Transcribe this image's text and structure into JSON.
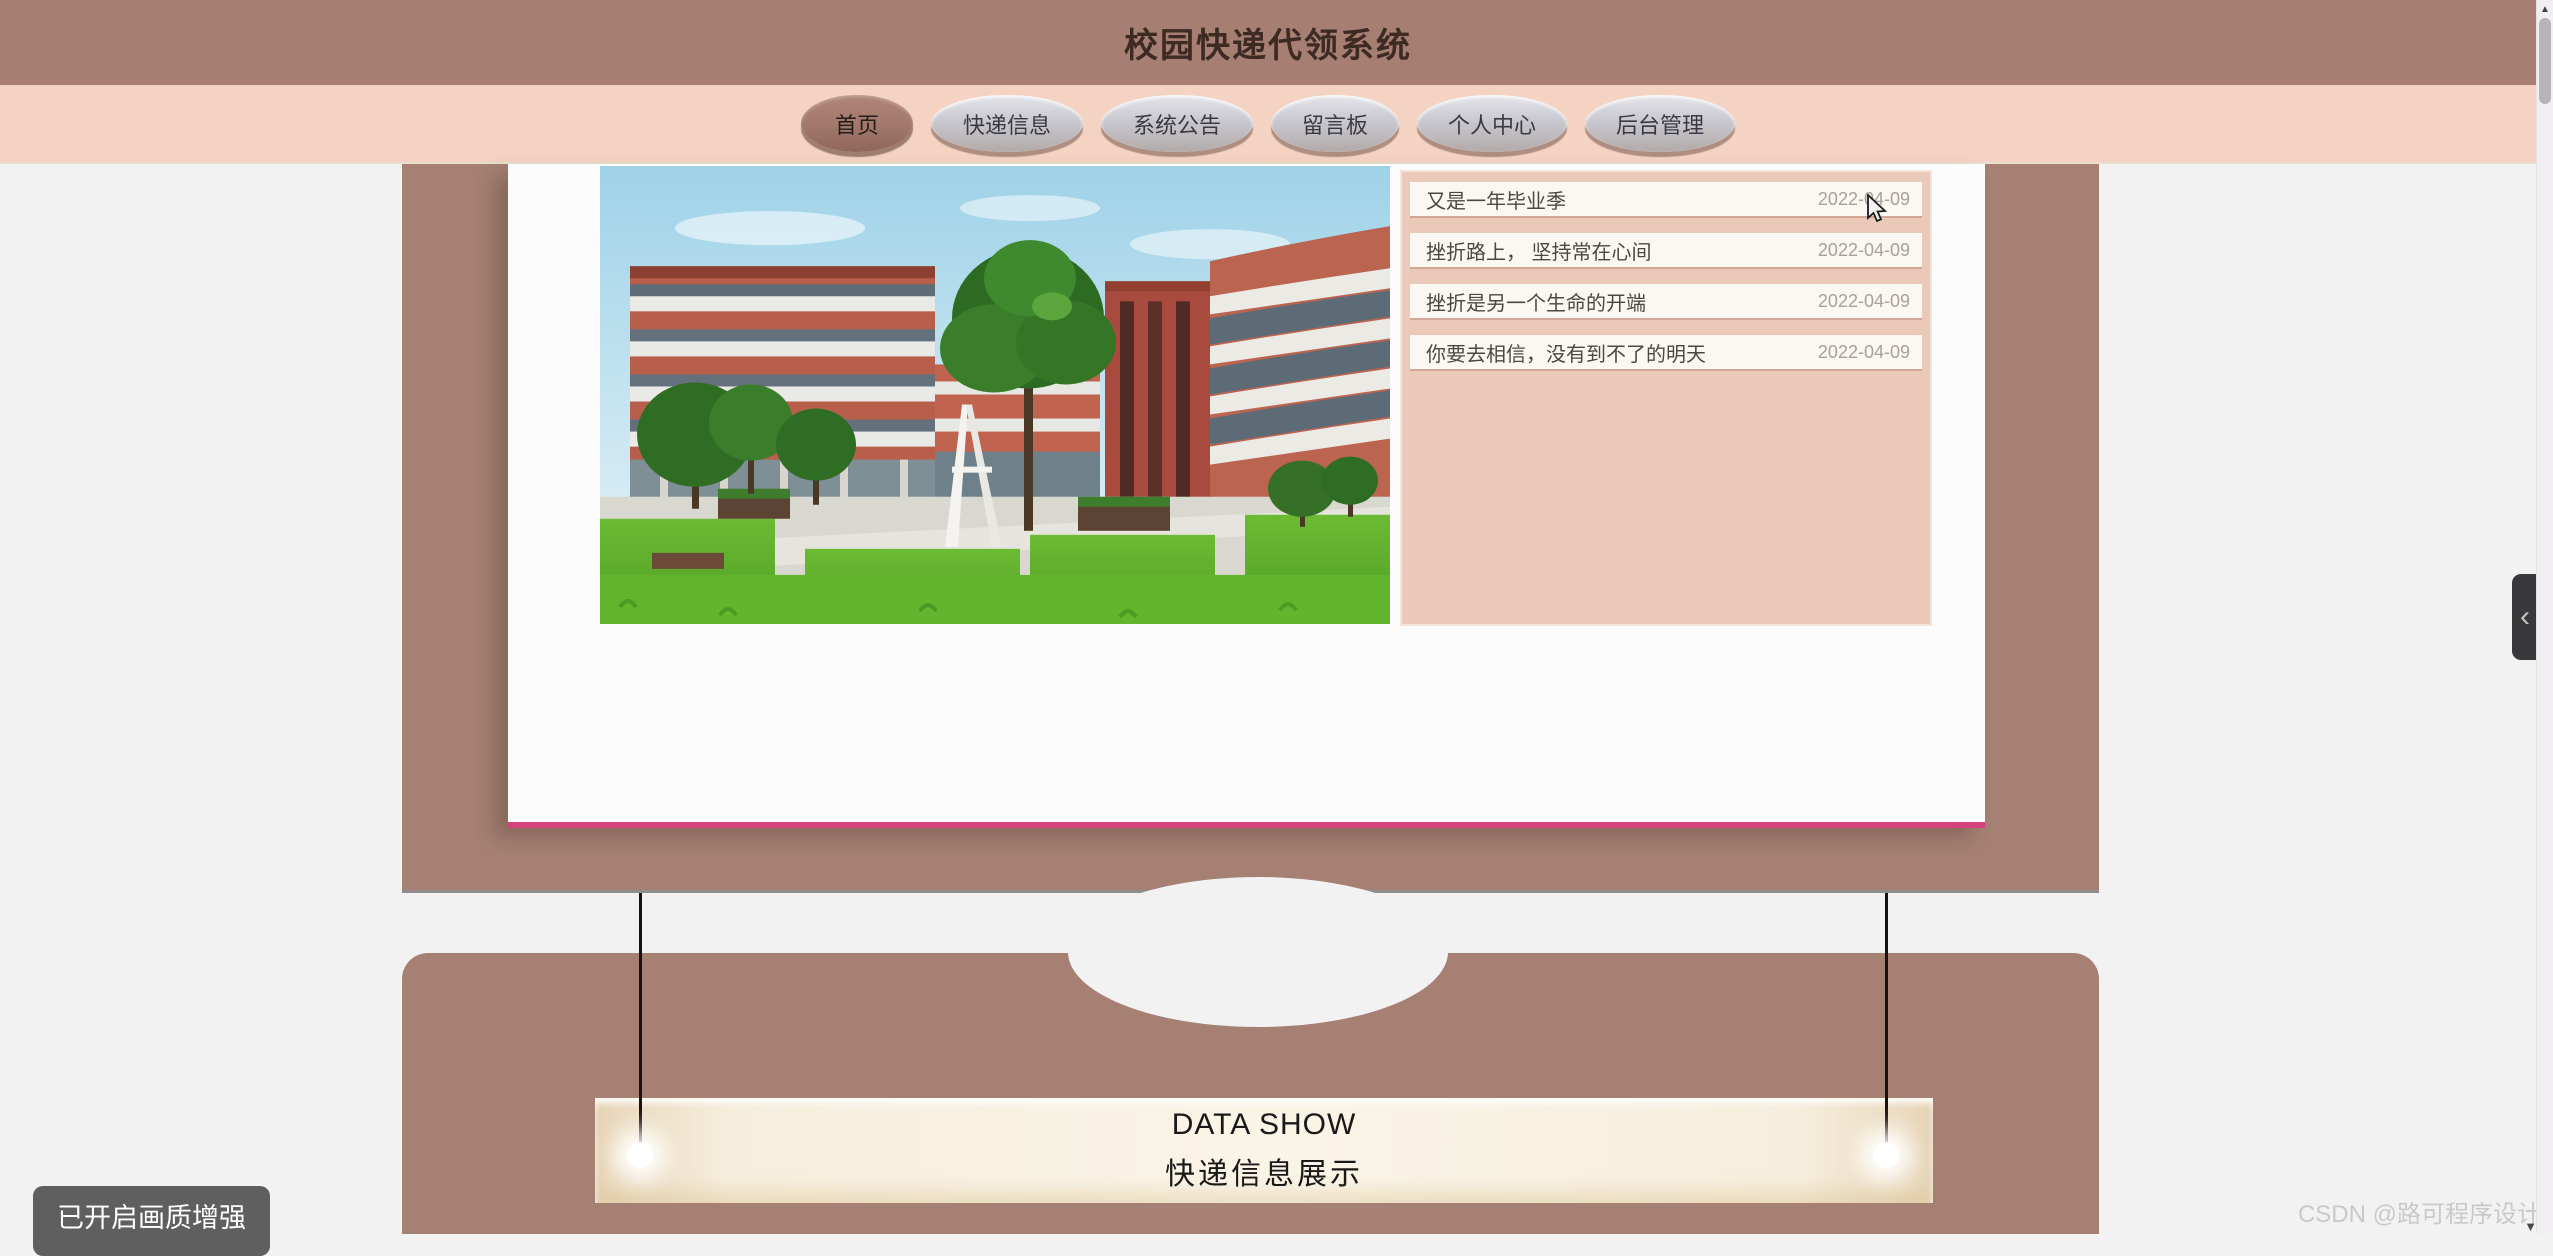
{
  "header": {
    "title": "校园快递代领系统"
  },
  "nav": {
    "items": [
      {
        "label": "首页",
        "active": true
      },
      {
        "label": "快递信息",
        "active": false
      },
      {
        "label": "系统公告",
        "active": false
      },
      {
        "label": "留言板",
        "active": false
      },
      {
        "label": "个人中心",
        "active": false
      },
      {
        "label": "后台管理",
        "active": false
      }
    ]
  },
  "news": {
    "items": [
      {
        "title": "又是一年毕业季",
        "date": "2022-04-09"
      },
      {
        "title": "挫折路上， 坚持常在心间",
        "date": "2022-04-09"
      },
      {
        "title": "挫折是另一个生命的开端",
        "date": "2022-04-09"
      },
      {
        "title": "你要去相信，没有到不了的明天",
        "date": "2022-04-09"
      }
    ]
  },
  "data_show": {
    "title_en": "DATA SHOW",
    "title_zh": "快递信息展示"
  },
  "overlays": {
    "quality_badge": "已开启画质增强",
    "watermark": "CSDN @路可程序设计",
    "watermark_caret": "▼"
  },
  "icons": {
    "collapse_chevron": "‹",
    "scroll_up_arrow": "▲"
  },
  "colors": {
    "header_bg": "#a67e72",
    "nav_bg": "#f5d3c3",
    "section_bg": "#a58073",
    "card_accent_pink": "#d6437c",
    "announcement_panel_bg": "#ebc9b9",
    "banner_cream": "#f6eedd",
    "page_bg": "#f3f2f3"
  }
}
